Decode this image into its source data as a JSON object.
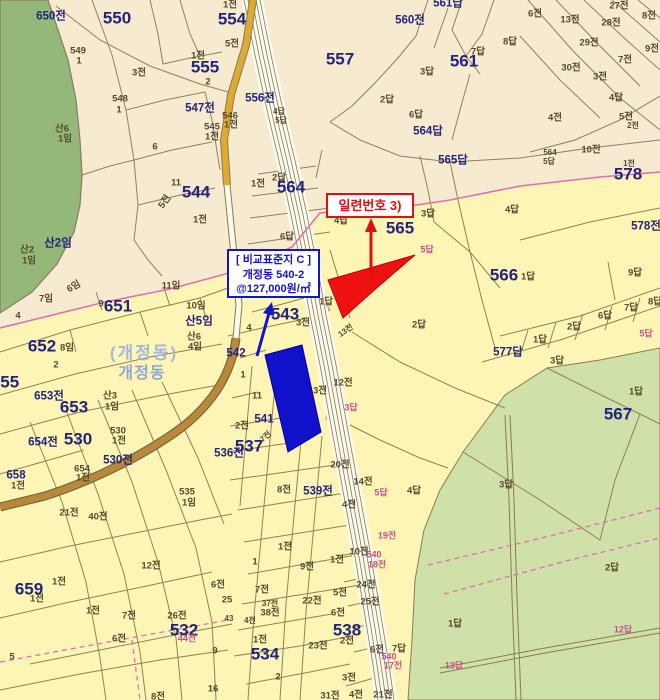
{
  "map_name": "cadastral-parcel-map",
  "district_labels": [
    "(개정동)",
    "개정동"
  ],
  "callouts": {
    "serial_number": {
      "text": "일련번호 3)"
    },
    "reference_parcel": {
      "title": "[ 비교표준지 C ]",
      "lot": "개정동 540-2",
      "price": "@127,000원/㎡"
    }
  },
  "colors": {
    "highlight_red": "#ee1111",
    "highlight_blue": "#1111cc",
    "boundary_pink": "#e070b0",
    "label_navy": "#23247c",
    "adjacent_label_pink": "#c75090",
    "forest_green": "#94b87a",
    "paddy_green": "#cfe0a8",
    "parcel_beige": "#f6ead0",
    "parcel_yellow": "#fcf5b5",
    "line_olive": "#8a7c4e",
    "road_yellow": "#ddaa33",
    "road_brown": "#b9883a"
  },
  "labels": [
    {
      "t": "650전",
      "x": 51,
      "y": 17,
      "c": "med"
    },
    {
      "t": "550",
      "x": 117,
      "y": 18,
      "c": "big"
    },
    {
      "t": "549",
      "x": 78,
      "y": 51,
      "c": "small"
    },
    {
      "t": "1",
      "x": 79,
      "y": 61,
      "c": "small"
    },
    {
      "t": "3전",
      "x": 139,
      "y": 73,
      "c": "small"
    },
    {
      "t": "1전",
      "x": 198,
      "y": 56,
      "c": "small"
    },
    {
      "t": "555",
      "x": 205,
      "y": 67,
      "c": "big"
    },
    {
      "t": "2",
      "x": 208,
      "y": 82,
      "c": "small"
    },
    {
      "t": "548",
      "x": 120,
      "y": 99,
      "c": "small"
    },
    {
      "t": "1",
      "x": 119,
      "y": 110,
      "c": "small"
    },
    {
      "t": "547전",
      "x": 200,
      "y": 109,
      "c": "med"
    },
    {
      "t": "546",
      "x": 230,
      "y": 116,
      "c": "small"
    },
    {
      "t": "1전",
      "x": 231,
      "y": 125,
      "c": "small"
    },
    {
      "t": "545",
      "x": 212,
      "y": 127,
      "c": "small"
    },
    {
      "t": "1전",
      "x": 212,
      "y": 137,
      "c": "small"
    },
    {
      "t": "산6",
      "x": 62,
      "y": 129,
      "c": "small"
    },
    {
      "t": "1임",
      "x": 65,
      "y": 139,
      "c": "small"
    },
    {
      "t": "6",
      "x": 155,
      "y": 147,
      "c": "small"
    },
    {
      "t": "1전",
      "x": 230,
      "y": 5,
      "c": "small"
    },
    {
      "t": "554",
      "x": 232,
      "y": 19,
      "c": "big"
    },
    {
      "t": "5전",
      "x": 232,
      "y": 44,
      "c": "small"
    },
    {
      "t": "556전",
      "x": 260,
      "y": 99,
      "c": "med"
    },
    {
      "t": "557",
      "x": 340,
      "y": 59,
      "c": "big"
    },
    {
      "t": "560전",
      "x": 410,
      "y": 21,
      "c": "med"
    },
    {
      "t": "561답",
      "x": 448,
      "y": 4,
      "c": "med"
    },
    {
      "t": "3답",
      "x": 427,
      "y": 72,
      "c": "small"
    },
    {
      "t": "2답",
      "x": 387,
      "y": 100,
      "c": "small"
    },
    {
      "t": "6답",
      "x": 416,
      "y": 115,
      "c": "small"
    },
    {
      "t": "564답",
      "x": 428,
      "y": 132,
      "c": "med"
    },
    {
      "t": "4답",
      "x": 279,
      "y": 112,
      "c": "tiny"
    },
    {
      "t": "5답",
      "x": 281,
      "y": 121,
      "c": "tiny"
    },
    {
      "t": "1전",
      "x": 258,
      "y": 184,
      "c": "small"
    },
    {
      "t": "2답",
      "x": 279,
      "y": 178,
      "c": "small"
    },
    {
      "t": "564",
      "x": 291,
      "y": 187,
      "c": "big"
    },
    {
      "t": "6전",
      "x": 535,
      "y": 14,
      "c": "small"
    },
    {
      "t": "13전",
      "x": 570,
      "y": 20,
      "c": "small"
    },
    {
      "t": "27전",
      "x": 619,
      "y": 6,
      "c": "small"
    },
    {
      "t": "28전",
      "x": 611,
      "y": 23,
      "c": "small"
    },
    {
      "t": "8전",
      "x": 649,
      "y": 16,
      "c": "small"
    },
    {
      "t": "29전",
      "x": 589,
      "y": 43,
      "c": "small"
    },
    {
      "t": "30전",
      "x": 571,
      "y": 68,
      "c": "small"
    },
    {
      "t": "7전",
      "x": 625,
      "y": 60,
      "c": "small"
    },
    {
      "t": "9전",
      "x": 652,
      "y": 49,
      "c": "small"
    },
    {
      "t": "3전",
      "x": 600,
      "y": 77,
      "c": "small"
    },
    {
      "t": "8답",
      "x": 510,
      "y": 42,
      "c": "small"
    },
    {
      "t": "7답",
      "x": 478,
      "y": 52,
      "c": "small"
    },
    {
      "t": "561",
      "x": 464,
      "y": 61,
      "c": "big"
    },
    {
      "t": "4답",
      "x": 616,
      "y": 98,
      "c": "small"
    },
    {
      "t": "4전",
      "x": 555,
      "y": 118,
      "c": "small"
    },
    {
      "t": "5전",
      "x": 626,
      "y": 117,
      "c": "small"
    },
    {
      "t": "2전",
      "x": 633,
      "y": 126,
      "c": "tiny"
    },
    {
      "t": "565답",
      "x": 453,
      "y": 161,
      "c": "med"
    },
    {
      "t": "564",
      "x": 550,
      "y": 153,
      "c": "tiny"
    },
    {
      "t": "5답",
      "x": 549,
      "y": 162,
      "c": "tiny"
    },
    {
      "t": "10전",
      "x": 591,
      "y": 150,
      "c": "small"
    },
    {
      "t": "1전",
      "x": 629,
      "y": 164,
      "c": "tiny"
    },
    {
      "t": "578",
      "x": 628,
      "y": 174,
      "c": "big"
    },
    {
      "t": "11",
      "x": 176,
      "y": 183,
      "c": "small"
    },
    {
      "t": "544",
      "x": 196,
      "y": 192,
      "c": "big"
    },
    {
      "t": "5전",
      "x": 165,
      "y": 202,
      "c": "small",
      "r": -55
    },
    {
      "t": "1전",
      "x": 200,
      "y": 220,
      "c": "small"
    },
    {
      "t": "산2임",
      "x": 58,
      "y": 244,
      "c": "med"
    },
    {
      "t": "산2",
      "x": 27,
      "y": 250,
      "c": "small"
    },
    {
      "t": "1임",
      "x": 29,
      "y": 261,
      "c": "small"
    },
    {
      "t": "6임",
      "x": 74,
      "y": 287,
      "c": "small",
      "r": -30
    },
    {
      "t": "7임",
      "x": 46,
      "y": 299,
      "c": "small"
    },
    {
      "t": "9",
      "x": 101,
      "y": 304,
      "c": "small"
    },
    {
      "t": "651",
      "x": 118,
      "y": 306,
      "c": "big"
    },
    {
      "t": "11임",
      "x": 171,
      "y": 286,
      "c": "small"
    },
    {
      "t": "10임",
      "x": 196,
      "y": 306,
      "c": "small"
    },
    {
      "t": "산5임",
      "x": 199,
      "y": 322,
      "c": "med"
    },
    {
      "t": "산6",
      "x": 194,
      "y": 337,
      "c": "small"
    },
    {
      "t": "4임",
      "x": 195,
      "y": 347,
      "c": "small"
    },
    {
      "t": "4",
      "x": 18,
      "y": 316,
      "c": "small"
    },
    {
      "t": "652",
      "x": 42,
      "y": 346,
      "c": "big"
    },
    {
      "t": "8임",
      "x": 67,
      "y": 348,
      "c": "small"
    },
    {
      "t": "2",
      "x": 56,
      "y": 365,
      "c": "small"
    },
    {
      "t": "655",
      "x": 5,
      "y": 382,
      "c": "big"
    },
    {
      "t": "653전",
      "x": 49,
      "y": 397,
      "c": "med"
    },
    {
      "t": "653",
      "x": 74,
      "y": 407,
      "c": "big"
    },
    {
      "t": "산3",
      "x": 110,
      "y": 396,
      "c": "small"
    },
    {
      "t": "1임",
      "x": 112,
      "y": 407,
      "c": "small"
    },
    {
      "t": "654전",
      "x": 43,
      "y": 443,
      "c": "med"
    },
    {
      "t": "530",
      "x": 78,
      "y": 439,
      "c": "big"
    },
    {
      "t": "530",
      "x": 118,
      "y": 431,
      "c": "small"
    },
    {
      "t": "1전",
      "x": 119,
      "y": 441,
      "c": "small"
    },
    {
      "t": "530전",
      "x": 118,
      "y": 461,
      "c": "med"
    },
    {
      "t": "654",
      "x": 82,
      "y": 469,
      "c": "small"
    },
    {
      "t": "1전",
      "x": 83,
      "y": 478,
      "c": "small"
    },
    {
      "t": "658",
      "x": 16,
      "y": 476,
      "c": "med"
    },
    {
      "t": "1전",
      "x": 18,
      "y": 486,
      "c": "small"
    },
    {
      "t": "535",
      "x": 187,
      "y": 492,
      "c": "small"
    },
    {
      "t": "1임",
      "x": 189,
      "y": 503,
      "c": "small"
    },
    {
      "t": "21전",
      "x": 69,
      "y": 513,
      "c": "small"
    },
    {
      "t": "40전",
      "x": 98,
      "y": 517,
      "c": "small"
    },
    {
      "t": "(개정동)",
      "x": 144,
      "y": 353,
      "c": "area"
    },
    {
      "t": "개정동",
      "x": 142,
      "y": 374,
      "c": "area2"
    },
    {
      "t": "4답",
      "x": 341,
      "y": 221,
      "c": "small"
    },
    {
      "t": "6답",
      "x": 287,
      "y": 237,
      "c": "small"
    },
    {
      "t": "565",
      "x": 400,
      "y": 228,
      "c": "big"
    },
    {
      "t": "3답",
      "x": 428,
      "y": 214,
      "c": "small"
    },
    {
      "t": "5답",
      "x": 427,
      "y": 250,
      "c": "pink"
    },
    {
      "t": "1답",
      "x": 326,
      "y": 302,
      "c": "small"
    },
    {
      "t": "13전",
      "x": 346,
      "y": 331,
      "c": "tiny",
      "r": -35
    },
    {
      "t": "2답",
      "x": 419,
      "y": 325,
      "c": "small"
    },
    {
      "t": "543",
      "x": 285,
      "y": 314,
      "c": "big"
    },
    {
      "t": "3전",
      "x": 303,
      "y": 323,
      "c": "small"
    },
    {
      "t": "4",
      "x": 249,
      "y": 328,
      "c": "small"
    },
    {
      "t": "542",
      "x": 236,
      "y": 354,
      "c": "med"
    },
    {
      "t": "4답",
      "x": 512,
      "y": 210,
      "c": "small"
    },
    {
      "t": "578전",
      "x": 646,
      "y": 227,
      "c": "med"
    },
    {
      "t": "566",
      "x": 504,
      "y": 275,
      "c": "big"
    },
    {
      "t": "1답",
      "x": 528,
      "y": 277,
      "c": "small"
    },
    {
      "t": "9답",
      "x": 635,
      "y": 273,
      "c": "small"
    },
    {
      "t": "8답",
      "x": 655,
      "y": 302,
      "c": "small"
    },
    {
      "t": "7답",
      "x": 631,
      "y": 308,
      "c": "small"
    },
    {
      "t": "6답",
      "x": 605,
      "y": 316,
      "c": "small"
    },
    {
      "t": "2답",
      "x": 574,
      "y": 327,
      "c": "small"
    },
    {
      "t": "1답",
      "x": 540,
      "y": 340,
      "c": "small"
    },
    {
      "t": "577답",
      "x": 508,
      "y": 353,
      "c": "med"
    },
    {
      "t": "5답",
      "x": 646,
      "y": 334,
      "c": "pink"
    },
    {
      "t": "3답",
      "x": 557,
      "y": 361,
      "c": "small"
    },
    {
      "t": "1답",
      "x": 636,
      "y": 392,
      "c": "small"
    },
    {
      "t": "567",
      "x": 618,
      "y": 414,
      "c": "big"
    },
    {
      "t": "3답",
      "x": 506,
      "y": 485,
      "c": "small"
    },
    {
      "t": "2답",
      "x": 612,
      "y": 568,
      "c": "small"
    },
    {
      "t": "1답",
      "x": 455,
      "y": 624,
      "c": "small"
    },
    {
      "t": "12답",
      "x": 623,
      "y": 630,
      "c": "pink"
    },
    {
      "t": "13답",
      "x": 454,
      "y": 666,
      "c": "pink"
    },
    {
      "t": "1",
      "x": 243,
      "y": 375,
      "c": "small"
    },
    {
      "t": "11",
      "x": 257,
      "y": 396,
      "c": "small"
    },
    {
      "t": "3전",
      "x": 320,
      "y": 391,
      "c": "small"
    },
    {
      "t": "12전",
      "x": 343,
      "y": 383,
      "c": "small"
    },
    {
      "t": "3답",
      "x": 351,
      "y": 408,
      "c": "pink"
    },
    {
      "t": "2전",
      "x": 242,
      "y": 426,
      "c": "small"
    },
    {
      "t": "541",
      "x": 264,
      "y": 420,
      "c": "med"
    },
    {
      "t": "7전",
      "x": 266,
      "y": 437,
      "c": "tiny",
      "r": -40
    },
    {
      "t": "537",
      "x": 249,
      "y": 446,
      "c": "big"
    },
    {
      "t": "536전",
      "x": 229,
      "y": 454,
      "c": "med"
    },
    {
      "t": "20전",
      "x": 340,
      "y": 465,
      "c": "small"
    },
    {
      "t": "8전",
      "x": 284,
      "y": 490,
      "c": "small"
    },
    {
      "t": "539전",
      "x": 318,
      "y": 492,
      "c": "med"
    },
    {
      "t": "14전",
      "x": 363,
      "y": 482,
      "c": "small"
    },
    {
      "t": "5답",
      "x": 381,
      "y": 493,
      "c": "pink"
    },
    {
      "t": "4전",
      "x": 349,
      "y": 505,
      "c": "small"
    },
    {
      "t": "4답",
      "x": 414,
      "y": 491,
      "c": "small"
    },
    {
      "t": "19전",
      "x": 387,
      "y": 536,
      "c": "pink"
    },
    {
      "t": "10전",
      "x": 359,
      "y": 552,
      "c": "small"
    },
    {
      "t": "540",
      "x": 374,
      "y": 555,
      "c": "pink"
    },
    {
      "t": "18전",
      "x": 377,
      "y": 565,
      "c": "pink"
    },
    {
      "t": "1전",
      "x": 285,
      "y": 547,
      "c": "small"
    },
    {
      "t": "9전",
      "x": 307,
      "y": 567,
      "c": "small"
    },
    {
      "t": "1전",
      "x": 337,
      "y": 560,
      "c": "small"
    },
    {
      "t": "1",
      "x": 255,
      "y": 562,
      "c": "small"
    },
    {
      "t": "7전",
      "x": 262,
      "y": 590,
      "c": "small"
    },
    {
      "t": "24전",
      "x": 366,
      "y": 585,
      "c": "small"
    },
    {
      "t": "5전",
      "x": 340,
      "y": 593,
      "c": "small"
    },
    {
      "t": "22전",
      "x": 312,
      "y": 601,
      "c": "small"
    },
    {
      "t": "25전",
      "x": 370,
      "y": 602,
      "c": "small"
    },
    {
      "t": "37전",
      "x": 270,
      "y": 604,
      "c": "tiny"
    },
    {
      "t": "38전",
      "x": 270,
      "y": 613,
      "c": "small"
    },
    {
      "t": "43",
      "x": 229,
      "y": 619,
      "c": "tiny"
    },
    {
      "t": "4전",
      "x": 250,
      "y": 621,
      "c": "tiny"
    },
    {
      "t": "6전",
      "x": 338,
      "y": 613,
      "c": "small"
    },
    {
      "t": "538",
      "x": 347,
      "y": 630,
      "c": "big"
    },
    {
      "t": "2전",
      "x": 347,
      "y": 641,
      "c": "small"
    },
    {
      "t": "1전",
      "x": 260,
      "y": 640,
      "c": "small"
    },
    {
      "t": "534",
      "x": 265,
      "y": 654,
      "c": "big"
    },
    {
      "t": "23전",
      "x": 318,
      "y": 646,
      "c": "small"
    },
    {
      "t": "6전",
      "x": 377,
      "y": 650,
      "c": "small"
    },
    {
      "t": "7답",
      "x": 399,
      "y": 649,
      "c": "small"
    },
    {
      "t": "540",
      "x": 389,
      "y": 657,
      "c": "pink"
    },
    {
      "t": "17전",
      "x": 393,
      "y": 666,
      "c": "pink"
    },
    {
      "t": "2",
      "x": 278,
      "y": 677,
      "c": "small"
    },
    {
      "t": "3전",
      "x": 349,
      "y": 678,
      "c": "small"
    },
    {
      "t": "31전",
      "x": 330,
      "y": 696,
      "c": "small"
    },
    {
      "t": "4전",
      "x": 356,
      "y": 695,
      "c": "small"
    },
    {
      "t": "21전",
      "x": 383,
      "y": 695,
      "c": "small"
    },
    {
      "t": "659",
      "x": 29,
      "y": 589,
      "c": "big"
    },
    {
      "t": "1전",
      "x": 37,
      "y": 599,
      "c": "small"
    },
    {
      "t": "1전",
      "x": 59,
      "y": 582,
      "c": "small"
    },
    {
      "t": "1전",
      "x": 93,
      "y": 611,
      "c": "small"
    },
    {
      "t": "12전",
      "x": 151,
      "y": 566,
      "c": "small"
    },
    {
      "t": "7전",
      "x": 129,
      "y": 616,
      "c": "small"
    },
    {
      "t": "6전",
      "x": 119,
      "y": 639,
      "c": "small"
    },
    {
      "t": "26전",
      "x": 177,
      "y": 616,
      "c": "small"
    },
    {
      "t": "532",
      "x": 184,
      "y": 630,
      "c": "big"
    },
    {
      "t": "44전",
      "x": 187,
      "y": 639,
      "c": "pink"
    },
    {
      "t": "6전",
      "x": 218,
      "y": 585,
      "c": "small"
    },
    {
      "t": "25",
      "x": 227,
      "y": 600,
      "c": "small"
    },
    {
      "t": "5",
      "x": 12,
      "y": 657,
      "c": "small"
    },
    {
      "t": "9",
      "x": 215,
      "y": 651,
      "c": "small"
    },
    {
      "t": "16",
      "x": 213,
      "y": 689,
      "c": "small"
    },
    {
      "t": "8전",
      "x": 158,
      "y": 697,
      "c": "small"
    }
  ]
}
